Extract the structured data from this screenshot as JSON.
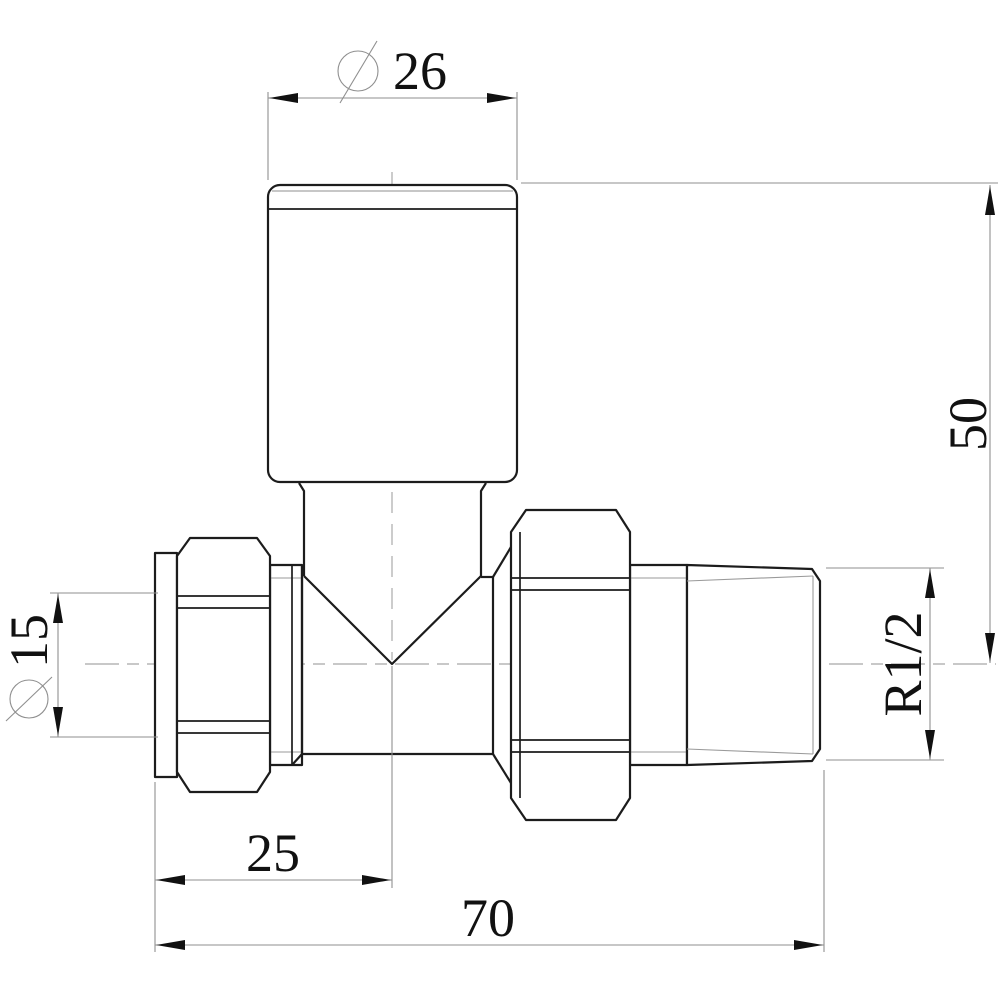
{
  "drawing": {
    "background_color": "#ffffff",
    "outline_color": "#1c1c1c",
    "thin_line_color": "#8f8f8f",
    "centerline_color": "#a8a8a8",
    "text_color": "#111111",
    "dimensions": {
      "top_diameter": {
        "symbol": "diameter-sign",
        "value": "26"
      },
      "body_height": {
        "value": "50"
      },
      "left_diameter": {
        "symbol": "diameter-sign",
        "value": "15"
      },
      "thread_size": {
        "value": "R1/2"
      },
      "tail_length": {
        "value": "25"
      },
      "overall_length": {
        "value": "70"
      }
    }
  }
}
